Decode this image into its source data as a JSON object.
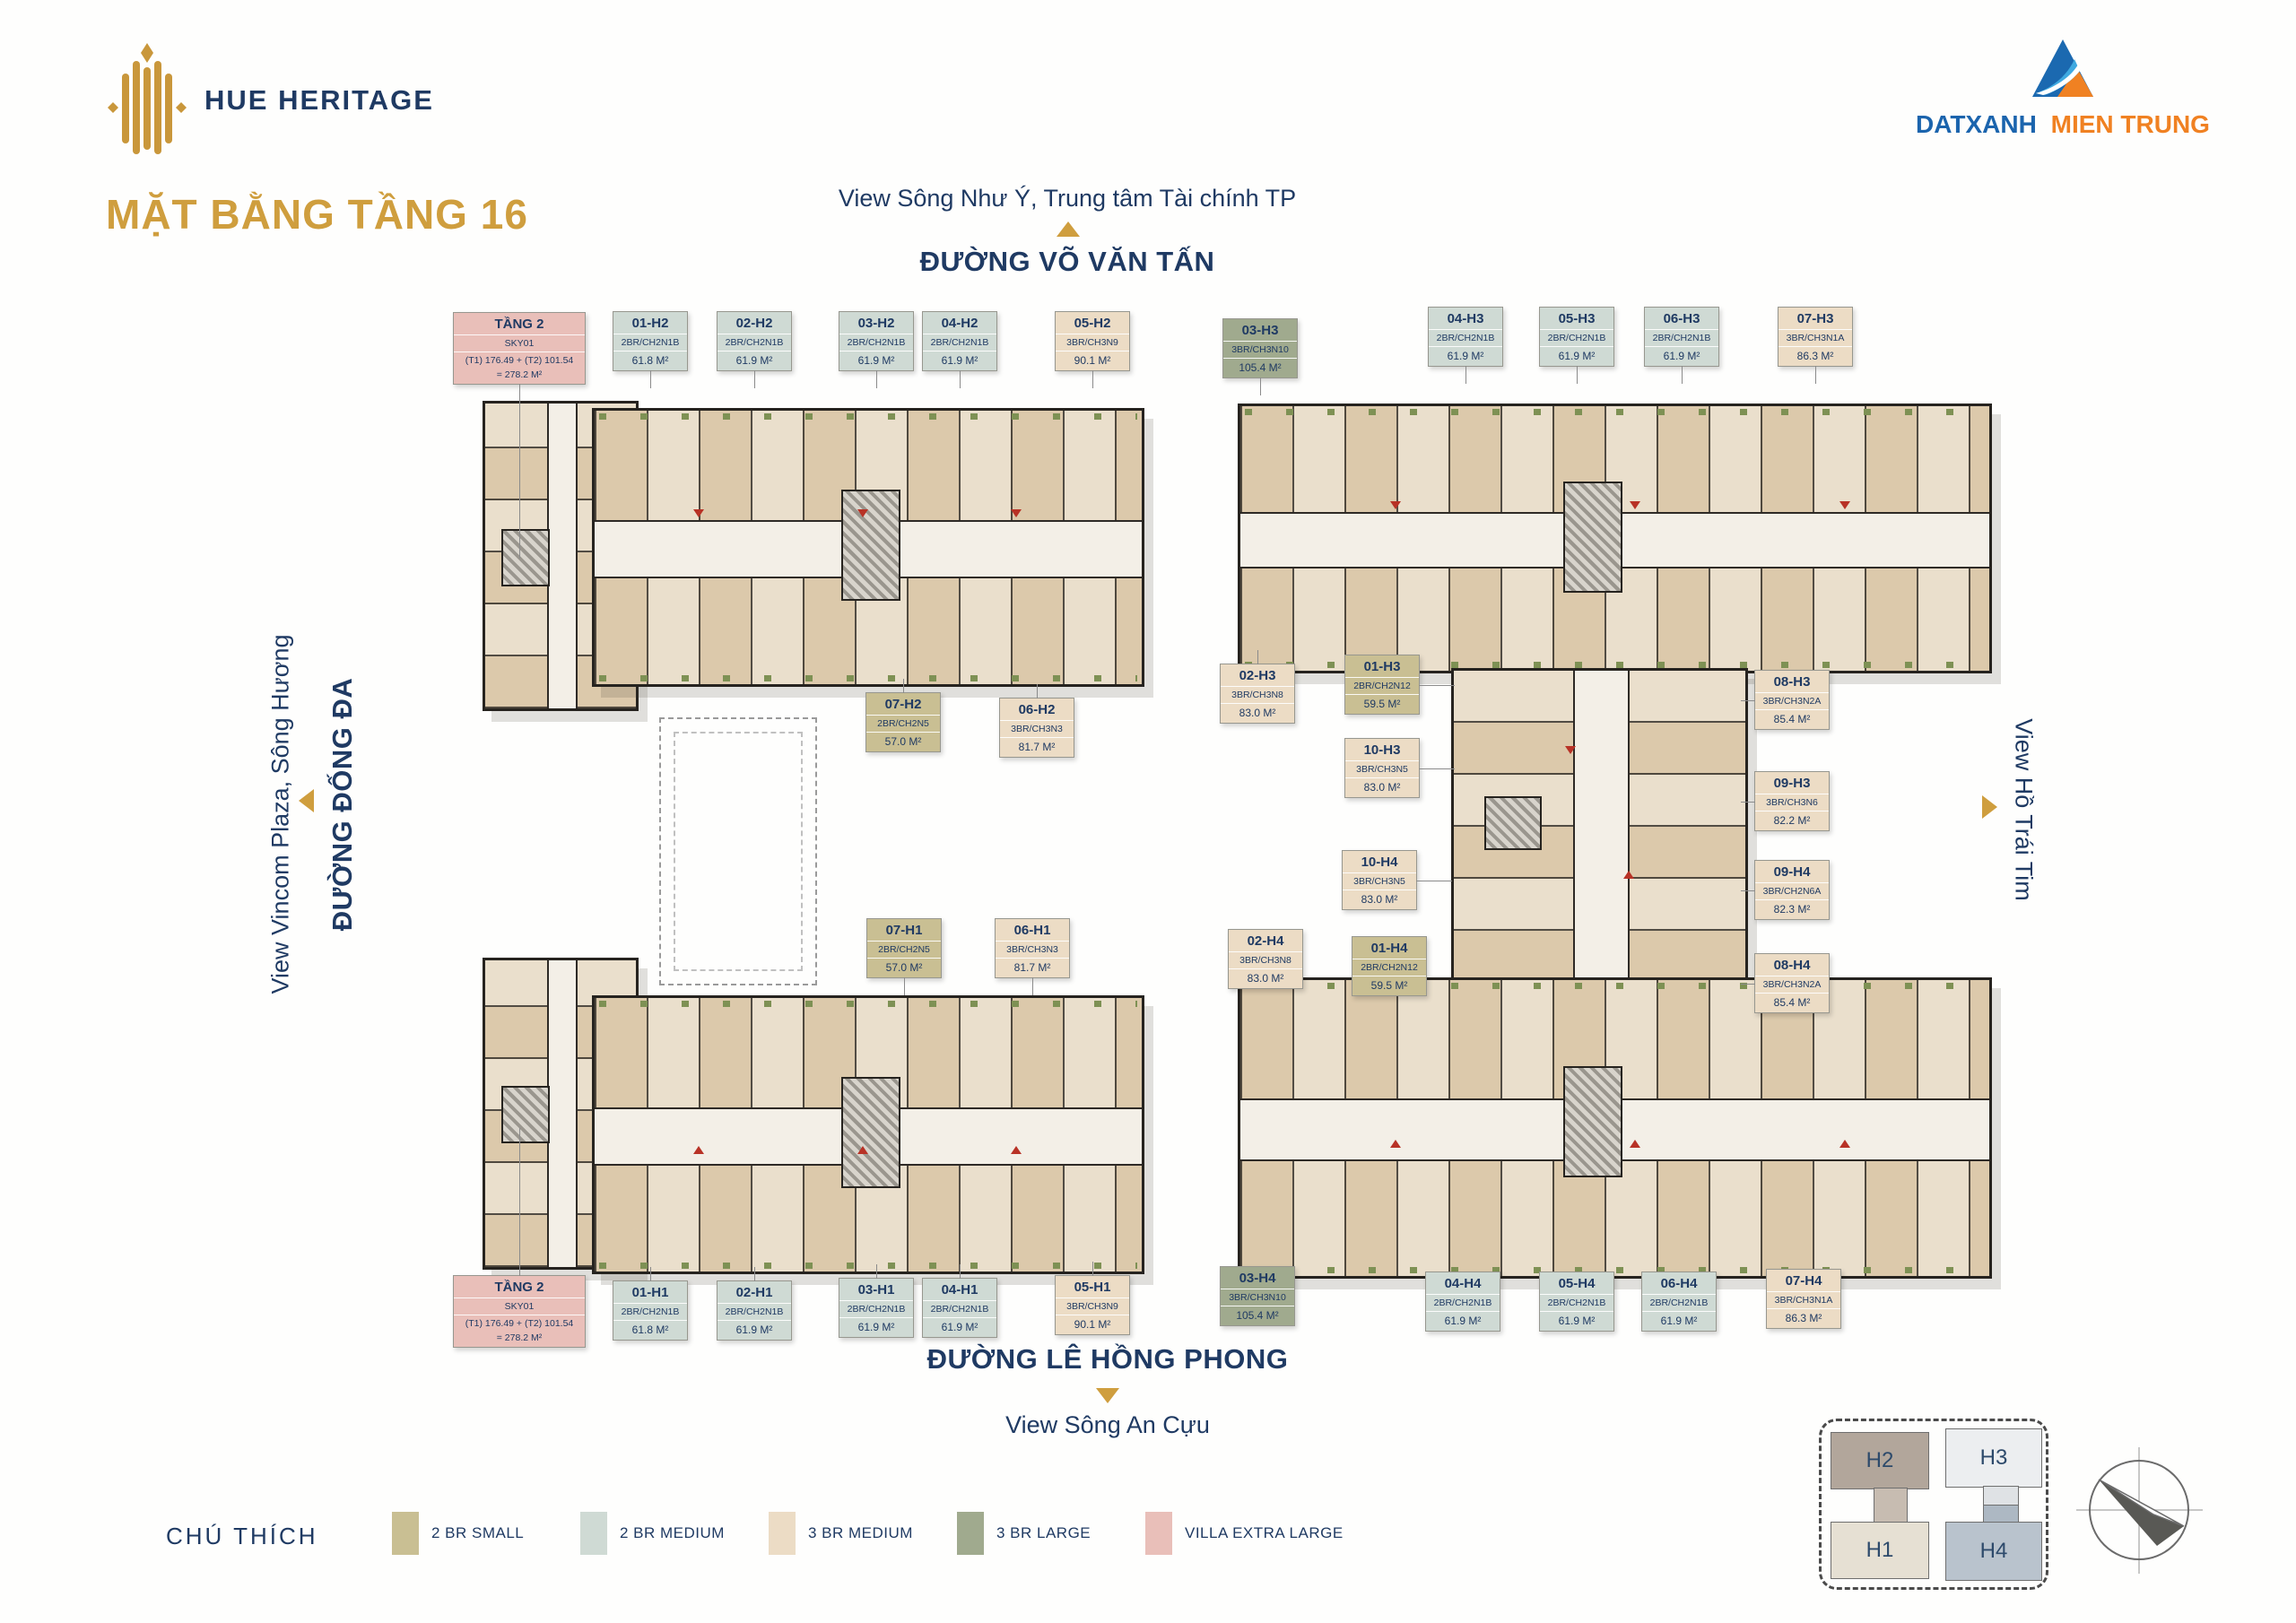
{
  "brand": {
    "logo_name": "HUE HERITAGE",
    "developer": {
      "name_blue": "DATXANH",
      "name_orange": "MIEN TRUNG"
    }
  },
  "page": {
    "title": "MẶT BẰNG TẦNG 16"
  },
  "surroundings": {
    "top_view": "View Sông Như Ý, Trung tâm Tài chính TP",
    "top_street": "ĐƯỜNG VÕ VĂN TẤN",
    "left_view": "View Vincom Plaza, Sông Hương",
    "left_street": "ĐƯỜNG ĐỐNG ĐA",
    "right_view": "View Hồ Trái Tim",
    "bottom_street": "ĐƯỜNG LÊ HỒNG PHONG",
    "bottom_view": "View Sông An Cựu"
  },
  "unit_categories": {
    "2br-small": "#c9bf93",
    "2br-medium": "#cfdad4",
    "3br-medium": "#ecdcc5",
    "3br-large": "#a0aa8e",
    "villa": "#e9bfb9"
  },
  "units": {
    "t2_top": {
      "id": "TẦNG 2",
      "type": "SKY01",
      "area": "(T1) 176.49 + (T2) 101.54",
      "area2": "= 278.2 M²",
      "cat": "villa"
    },
    "t2_bottom": {
      "id": "TẦNG 2",
      "type": "SKY01",
      "area": "(T1) 176.49 + (T2) 101.54",
      "area2": "= 278.2 M²",
      "cat": "villa"
    },
    "u01h2": {
      "id": "01-H2",
      "type": "2BR/CH2N1B",
      "area": "61.8 M²",
      "cat": "2br-medium"
    },
    "u02h2": {
      "id": "02-H2",
      "type": "2BR/CH2N1B",
      "area": "61.9 M²",
      "cat": "2br-medium"
    },
    "u03h2": {
      "id": "03-H2",
      "type": "2BR/CH2N1B",
      "area": "61.9 M²",
      "cat": "2br-medium"
    },
    "u04h2": {
      "id": "04-H2",
      "type": "2BR/CH2N1B",
      "area": "61.9 M²",
      "cat": "2br-medium"
    },
    "u05h2": {
      "id": "05-H2",
      "type": "3BR/CH3N9",
      "area": "90.1 M²",
      "cat": "3br-medium"
    },
    "u06h2": {
      "id": "06-H2",
      "type": "3BR/CH3N3",
      "area": "81.7 M²",
      "cat": "3br-medium"
    },
    "u07h2": {
      "id": "07-H2",
      "type": "2BR/CH2N5",
      "area": "57.0 M²",
      "cat": "2br-small"
    },
    "u01h3": {
      "id": "01-H3",
      "type": "2BR/CH2N12",
      "area": "59.5 M²",
      "cat": "2br-small"
    },
    "u02h3": {
      "id": "02-H3",
      "type": "3BR/CH3N8",
      "area": "83.0 M²",
      "cat": "3br-medium"
    },
    "u03h3": {
      "id": "03-H3",
      "type": "3BR/CH3N10",
      "area": "105.4 M²",
      "cat": "3br-large"
    },
    "u04h3": {
      "id": "04-H3",
      "type": "2BR/CH2N1B",
      "area": "61.9 M²",
      "cat": "2br-medium"
    },
    "u05h3": {
      "id": "05-H3",
      "type": "2BR/CH2N1B",
      "area": "61.9 M²",
      "cat": "2br-medium"
    },
    "u06h3": {
      "id": "06-H3",
      "type": "2BR/CH2N1B",
      "area": "61.9 M²",
      "cat": "2br-medium"
    },
    "u07h3": {
      "id": "07-H3",
      "type": "3BR/CH3N1A",
      "area": "86.3 M²",
      "cat": "3br-medium"
    },
    "u08h3": {
      "id": "08-H3",
      "type": "3BR/CH3N2A",
      "area": "85.4 M²",
      "cat": "3br-medium"
    },
    "u09h3": {
      "id": "09-H3",
      "type": "3BR/CH3N6",
      "area": "82.2 M²",
      "cat": "3br-medium"
    },
    "u10h3": {
      "id": "10-H3",
      "type": "3BR/CH3N5",
      "area": "83.0 M²",
      "cat": "3br-medium"
    },
    "u01h1": {
      "id": "01-H1",
      "type": "2BR/CH2N1B",
      "area": "61.8 M²",
      "cat": "2br-medium"
    },
    "u02h1": {
      "id": "02-H1",
      "type": "2BR/CH2N1B",
      "area": "61.9 M²",
      "cat": "2br-medium"
    },
    "u03h1": {
      "id": "03-H1",
      "type": "2BR/CH2N1B",
      "area": "61.9 M²",
      "cat": "2br-medium"
    },
    "u04h1": {
      "id": "04-H1",
      "type": "2BR/CH2N1B",
      "area": "61.9 M²",
      "cat": "2br-medium"
    },
    "u05h1": {
      "id": "05-H1",
      "type": "3BR/CH3N9",
      "area": "90.1 M²",
      "cat": "3br-medium"
    },
    "u06h1": {
      "id": "06-H1",
      "type": "3BR/CH3N3",
      "area": "81.7 M²",
      "cat": "3br-medium"
    },
    "u07h1": {
      "id": "07-H1",
      "type": "2BR/CH2N5",
      "area": "57.0 M²",
      "cat": "2br-small"
    },
    "u01h4": {
      "id": "01-H4",
      "type": "2BR/CH2N12",
      "area": "59.5 M²",
      "cat": "2br-small"
    },
    "u02h4": {
      "id": "02-H4",
      "type": "3BR/CH3N8",
      "area": "83.0 M²",
      "cat": "3br-medium"
    },
    "u03h4": {
      "id": "03-H4",
      "type": "3BR/CH3N10",
      "area": "105.4 M²",
      "cat": "3br-large"
    },
    "u04h4": {
      "id": "04-H4",
      "type": "2BR/CH2N1B",
      "area": "61.9 M²",
      "cat": "2br-medium"
    },
    "u05h4": {
      "id": "05-H4",
      "type": "2BR/CH2N1B",
      "area": "61.9 M²",
      "cat": "2br-medium"
    },
    "u06h4": {
      "id": "06-H4",
      "type": "2BR/CH2N1B",
      "area": "61.9 M²",
      "cat": "2br-medium"
    },
    "u07h4": {
      "id": "07-H4",
      "type": "3BR/CH3N1A",
      "area": "86.3 M²",
      "cat": "3br-medium"
    },
    "u08h4": {
      "id": "08-H4",
      "type": "3BR/CH3N2A",
      "area": "85.4 M²",
      "cat": "3br-medium"
    },
    "u09h4": {
      "id": "09-H4",
      "type": "3BR/CH2N6A",
      "area": "82.3 M²",
      "cat": "3br-medium"
    },
    "u10h4": {
      "id": "10-H4",
      "type": "3BR/CH3N5",
      "area": "83.0 M²",
      "cat": "3br-medium"
    }
  },
  "legend": {
    "title": "CHÚ THÍCH",
    "items": [
      {
        "label": "2 BR SMALL",
        "color": "#c9bf93"
      },
      {
        "label": "2 BR MEDIUM",
        "color": "#cfdad4"
      },
      {
        "label": "3 BR MEDIUM",
        "color": "#ecdcc5"
      },
      {
        "label": "3 BR LARGE",
        "color": "#a0aa8e"
      },
      {
        "label": "VILLA EXTRA LARGE",
        "color": "#e9bfb9"
      }
    ]
  },
  "key_plan": {
    "h1": "H1",
    "h2": "H2",
    "h3": "H3",
    "h4": "H4"
  }
}
